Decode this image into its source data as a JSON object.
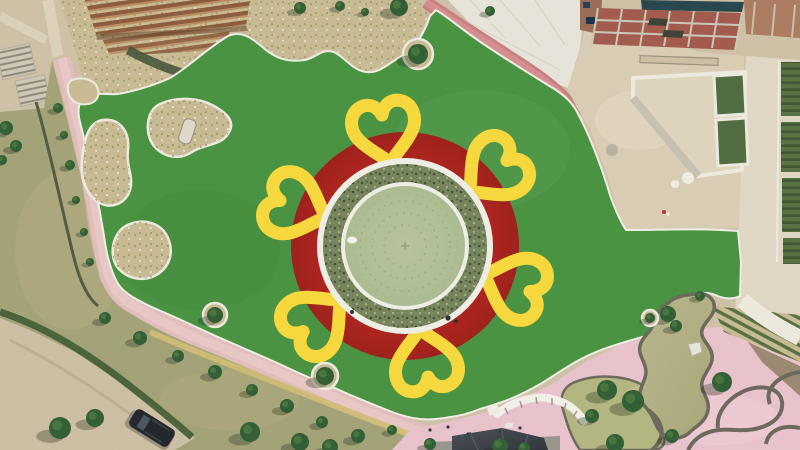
{
  "scene": {
    "title": "Aerial drone view of a flower-themed park plaza under construction",
    "regions": [
      {
        "name": "artificial-lawn",
        "desc": "large green turf lawn"
      },
      {
        "name": "flower-plaza",
        "desc": "central circular plaza styled as a sunflower with red disc and yellow heart petals"
      },
      {
        "name": "pergola-garden",
        "desc": "wooden pergola and shrub garden, top left"
      },
      {
        "name": "construction-site",
        "desc": "brick building and sandy works area, top right"
      },
      {
        "name": "pond-garden",
        "desc": "curvy ornamental pond with pink paving, bottom right"
      },
      {
        "name": "natural-grass",
        "desc": "rough grass band with tree-lined path, bottom left"
      },
      {
        "name": "dirt-road",
        "desc": "dirt road with parked vehicle, bottom left corner"
      }
    ]
  },
  "palette": {
    "dirtBase": "#CFC1A6",
    "roadDirt": "#CDBFA4",
    "lawnGreen": "#47923F",
    "lawnGreenLight": "#549C4A",
    "discRed": "#B1221C",
    "petalYellow": "#F8D93B",
    "ringWhite": "#F0EFE6",
    "vegRing": "#75845A",
    "vegDark": "#3E4F33",
    "vegLight": "#A8B389",
    "plazaSage": "#B7C49C",
    "plazaSageEdge": "#ABBC90",
    "dotRing": "#97AC7C",
    "pathPink": "#E2BEBC",
    "pathPinkLight": "#EBCBC8",
    "brickPath": "#C97F80",
    "brickPathLight": "#D89193",
    "plazaPink": "#EAC3CC",
    "plazaPinkLight": "#F0CDD5",
    "sand": "#DACDB4",
    "sandLight": "#E4D9C4",
    "concrete": "#E7E5DB",
    "concreteCol": "#E0D8C4",
    "naturalGrass": "#A3A276",
    "grassPatch": "#B7AE82",
    "pondWater": "#A9A878",
    "pondWaterLight": "#B8B58A",
    "stoneDark": "#6B675A",
    "bedTan": "#C9BB92",
    "bedEdge": "#EDEAE0",
    "treeGreen": "#2F5D33",
    "hedgeGreen": "#3E5A31",
    "rowGreen": "#55703F",
    "brick": "#A2594A",
    "brickPave": "#AB7B5F",
    "beamGray": "#CBC7BA",
    "tealRoof": "#25454C",
    "panelGreen": "#4F6B3E",
    "pergolaWood": "#8A5A3A",
    "pergolaWoodLight": "#B98C60",
    "stairLight": "#CFC8B6",
    "stairDark": "#8F897A",
    "tentDark": "#2E3338",
    "padGray": "#98958A",
    "flowerStrip": "#D2BC74",
    "vehicleDark": "#20242A"
  },
  "flower": {
    "cx": 405,
    "cy": 246,
    "disc_radius": 114,
    "outer_ring_radius": 88,
    "veg_outer_radius": 82,
    "veg_inner_radius": 64,
    "plaza_radius": 60,
    "petal_count": 6,
    "petal_ring_radius": 124,
    "petal_angles_deg": [
      100,
      40,
      -20,
      -80,
      -140,
      160
    ],
    "dotted_circle_radii": [
      21,
      33,
      45,
      52
    ]
  },
  "trees": {
    "path_line": [
      [
        105,
        318,
        6
      ],
      [
        140,
        338,
        7
      ],
      [
        178,
        356,
        6
      ],
      [
        215,
        372,
        7
      ],
      [
        252,
        390,
        6
      ],
      [
        287,
        406,
        7
      ],
      [
        322,
        422,
        6
      ],
      [
        358,
        436,
        7
      ],
      [
        392,
        430,
        5
      ],
      [
        430,
        444,
        6
      ]
    ],
    "grass": [
      [
        60,
        428,
        11
      ],
      [
        95,
        418,
        9
      ],
      [
        250,
        432,
        10
      ],
      [
        300,
        442,
        9
      ],
      [
        330,
        447,
        8
      ],
      [
        500,
        446,
        8
      ],
      [
        524,
        448,
        6
      ]
    ],
    "left_path": [
      [
        58,
        108,
        5
      ],
      [
        64,
        135,
        4
      ],
      [
        70,
        165,
        5
      ],
      [
        76,
        200,
        4
      ],
      [
        84,
        232,
        4
      ],
      [
        90,
        262,
        4
      ]
    ],
    "top_garden": [
      [
        300,
        8,
        6
      ],
      [
        340,
        6,
        5
      ],
      [
        365,
        12,
        4
      ],
      [
        399,
        7,
        9
      ],
      [
        490,
        11,
        5
      ]
    ],
    "pond": [
      [
        668,
        314,
        8
      ],
      [
        676,
        326,
        6
      ],
      [
        722,
        382,
        10
      ],
      [
        700,
        296,
        5
      ],
      [
        672,
        436,
        7
      ]
    ],
    "mound": [
      [
        607,
        390,
        10
      ],
      [
        633,
        401,
        11
      ],
      [
        592,
        416,
        7
      ],
      [
        615,
        443,
        9
      ]
    ],
    "corner": [
      [
        6,
        128,
        7
      ],
      [
        16,
        146,
        6
      ],
      [
        2,
        160,
        5
      ]
    ]
  },
  "lawn_islands": [
    {
      "cx": 215,
      "cy": 315,
      "ring_r": 12,
      "tree_r": 8
    },
    {
      "cx": 325,
      "cy": 376,
      "ring_r": 13,
      "tree_r": 9
    },
    {
      "cx": 418,
      "cy": 54,
      "ring_r": 15,
      "tree_r": 10
    },
    {
      "cx": 650,
      "cy": 318,
      "ring_r": 8,
      "tree_r": 5
    }
  ],
  "objects": {
    "vehicle": {
      "cx": 152,
      "cy": 428,
      "angle": 32,
      "length": 46,
      "width": 20
    },
    "pond_rock": {
      "x": 694,
      "y": 348
    },
    "bed_rock": {
      "x": 188,
      "y": 131
    },
    "people_dots": [
      [
        430,
        430
      ],
      [
        448,
        427
      ],
      [
        468,
        434
      ],
      [
        500,
        431
      ],
      [
        520,
        428
      ],
      [
        664,
        212
      ]
    ],
    "red_speck": [
      664,
      212
    ]
  }
}
